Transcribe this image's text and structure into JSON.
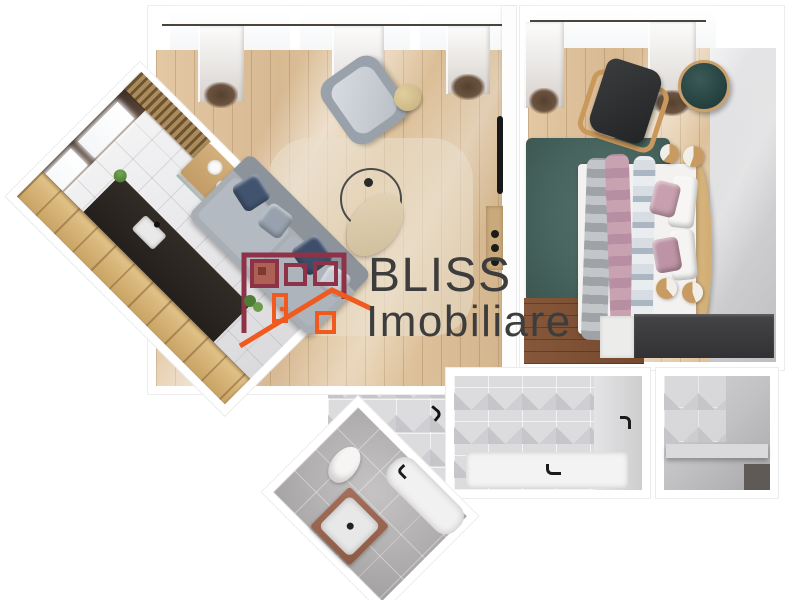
{
  "watermark": {
    "line1": "BLISS",
    "line2": "Imobiliare",
    "text_color": "#3e3d3d",
    "logo_colors": {
      "house_outline": "#8e3347",
      "roof_and_door": "#f05a1e"
    }
  },
  "icons": [
    "bliss-house-logo",
    "door-handle-icon",
    "wall-hook-icon",
    "faucet-icon"
  ],
  "scene": {
    "type": "apartment-floor-plan-3d-render",
    "rooms": [
      "living-room",
      "bedroom",
      "kitchen-corridor",
      "bathroom",
      "entry-hall",
      "storage-room"
    ],
    "palette": {
      "wood_floor_light": "#dcc09c",
      "wood_floor_walnut": "#7c5236",
      "oak_cabinets": "#d5b276",
      "rug_teal": "#47645e",
      "rug_beige": "#e9e0cb",
      "sofa_gray": "#a9aeb5",
      "pillow_navy": "#41536e",
      "bed_white": "#f3f2f0",
      "blanket_pink": "#c9a2b2",
      "blanket_blue_gray": "#aab6c2",
      "kitchen_counter_dark": "#2b2622",
      "hall_tile_gray": "#dcdbdd",
      "bath_floor_gray": "#b7b4b6",
      "wardrobe_dark": "#39383b"
    }
  }
}
